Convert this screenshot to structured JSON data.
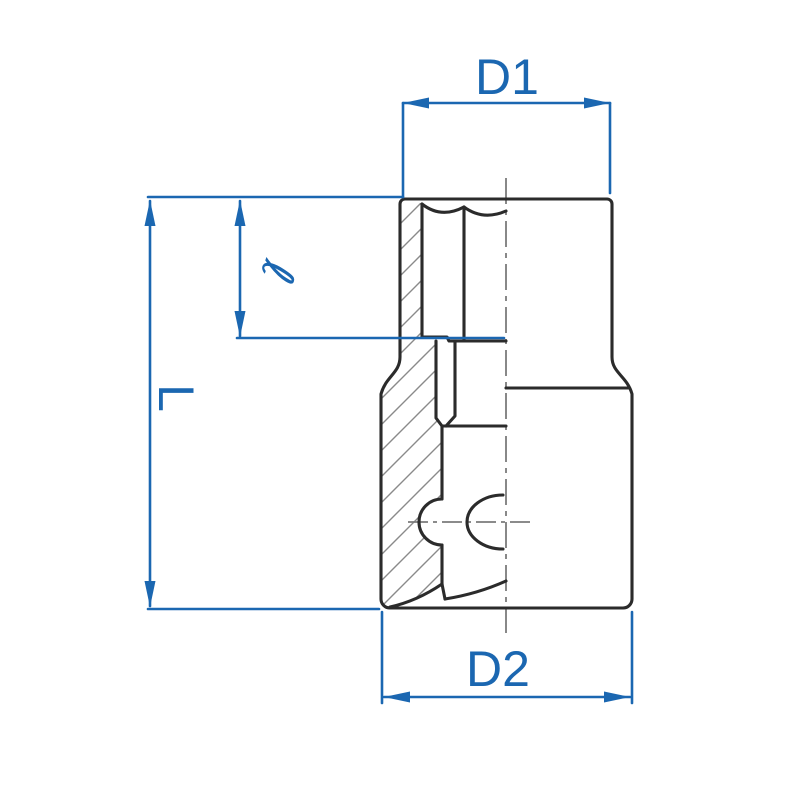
{
  "diagram": {
    "type": "technical-dimension-drawing",
    "subject": "socket half-section drawing",
    "labels": {
      "top_diameter": "D1",
      "bottom_diameter": "D2",
      "overall_length": "L",
      "drive_depth": "ℓ"
    },
    "colors": {
      "dimension_blue": "#1b67b1",
      "outline_black": "#2b2b2b",
      "hatch_gray": "#8a8a8a",
      "centerline_gray": "#7b7b7b",
      "background": "#ffffff"
    }
  }
}
